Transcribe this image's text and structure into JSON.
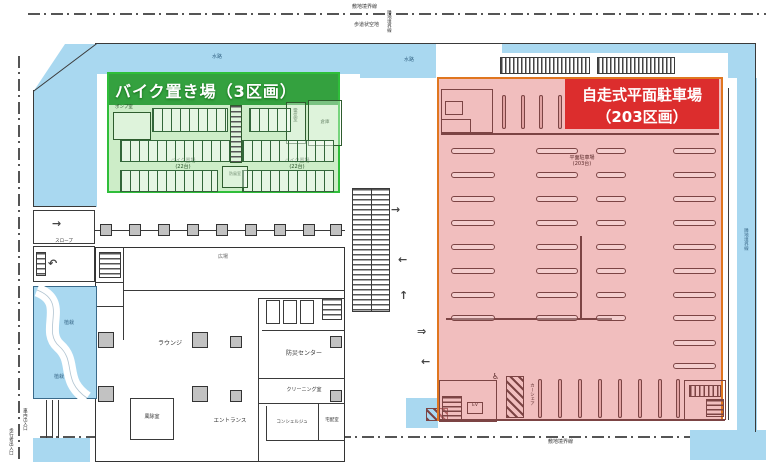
{
  "legend": {
    "bike_zone_label": "バイク置き場（3区画）",
    "parking_zone_label_line1": "自走式平面駐車場",
    "parking_zone_label_line2": "（203区画）"
  },
  "green_zone": {
    "rack_label_left": "バイク置場",
    "rack_count_left": "(22台)",
    "rack_label_right": "バイク置場",
    "rack_count_right": "(22台)",
    "room_pump": "ポンプ室",
    "room_electric": "電気室",
    "room_storage": "倉庫",
    "room_vestibule": "防風室"
  },
  "red_zone": {
    "center_label": "平面駐車場",
    "center_count": "(203台)",
    "ev_label": "EV",
    "carshare_label": "カーシェア",
    "accessible_icon": "♿"
  },
  "building": {
    "lounge": "ラウンジ",
    "entrance": "エントランス",
    "windbreak_room": "風除室",
    "disaster_center": "防災センター",
    "cleaning_room": "クリーニング室",
    "concierge": "コンシェルジュ",
    "delivery_room": "宅配室",
    "slope": "スロープ"
  },
  "site": {
    "boundary_top": "敷地境界線",
    "walkway_top": "歩道状空地",
    "boundary_neighbor_left": "隣地境界線",
    "boundary_bottom": "敷地境界線",
    "boundary_right": "隣地境界線",
    "entrance_vehicle": "車両出入口",
    "entrance_pedestrian": "歩行者出入口",
    "water_label_1": "水路",
    "water_label_2": "水路",
    "planting_1": "植栽",
    "planting_2": "植栽",
    "plaza": "広場"
  },
  "arrows": [
    {
      "glyph": "→",
      "x": 52,
      "y": 218
    },
    {
      "glyph": "↶",
      "x": 48,
      "y": 258
    },
    {
      "glyph": "→",
      "x": 391,
      "y": 204
    },
    {
      "glyph": "←",
      "x": 398,
      "y": 254
    },
    {
      "glyph": "↑",
      "x": 399,
      "y": 290
    },
    {
      "glyph": "⇒",
      "x": 417,
      "y": 326
    },
    {
      "glyph": "←",
      "x": 421,
      "y": 356
    }
  ],
  "colors": {
    "water": "#a9d8f0",
    "green_border": "#2fbe3a",
    "green_band": "#239830",
    "red_border": "#e0761f",
    "red_label_bg": "#dc2d2d",
    "plan_line": "#3a3a3a",
    "parking_line": "#7c4444"
  }
}
